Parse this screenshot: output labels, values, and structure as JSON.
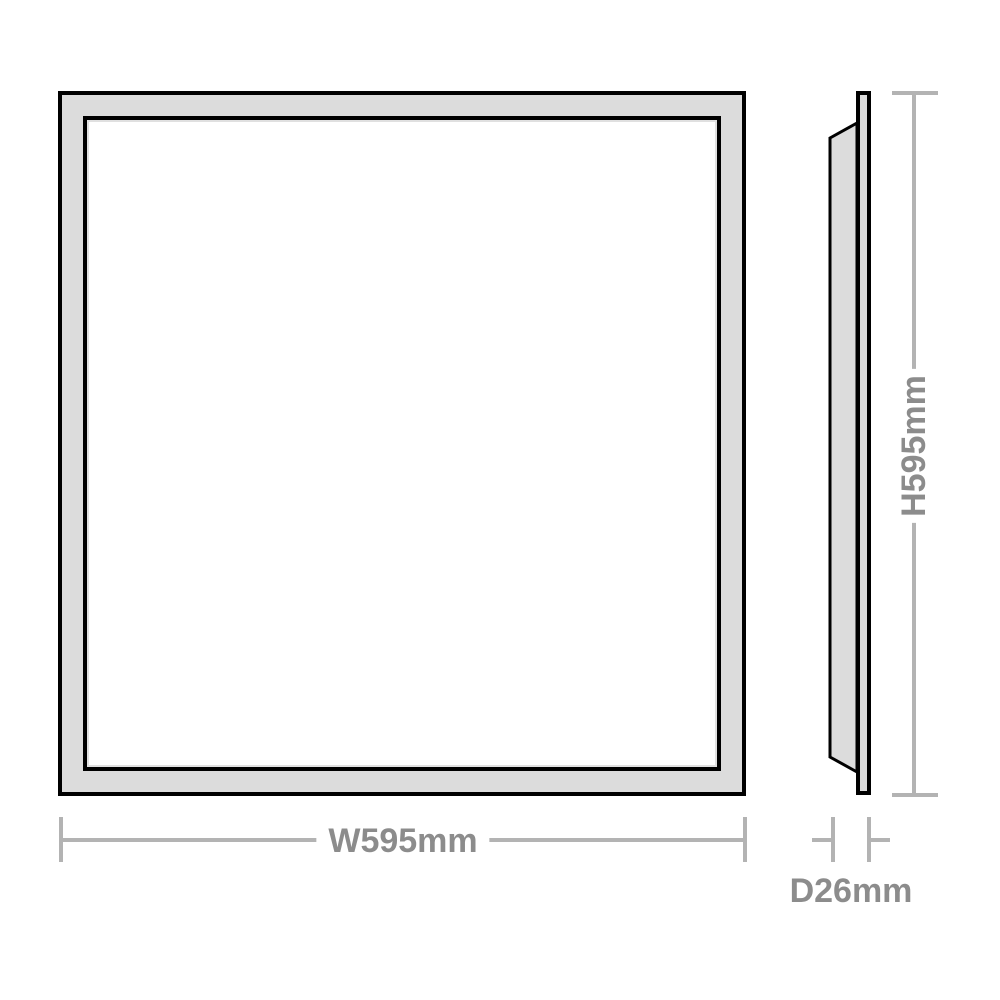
{
  "dimensions": {
    "width": {
      "label": "W595mm"
    },
    "height": {
      "label": "H595mm"
    },
    "depth": {
      "label": "D26mm"
    }
  },
  "colors": {
    "background": "#ffffff",
    "panel_outline": "#000000",
    "panel_frame_fill": "#dcdcdc",
    "panel_face_fill": "#ffffff",
    "dimension_line": "#b3b3b3",
    "dimension_text": "#8c8c8c"
  }
}
